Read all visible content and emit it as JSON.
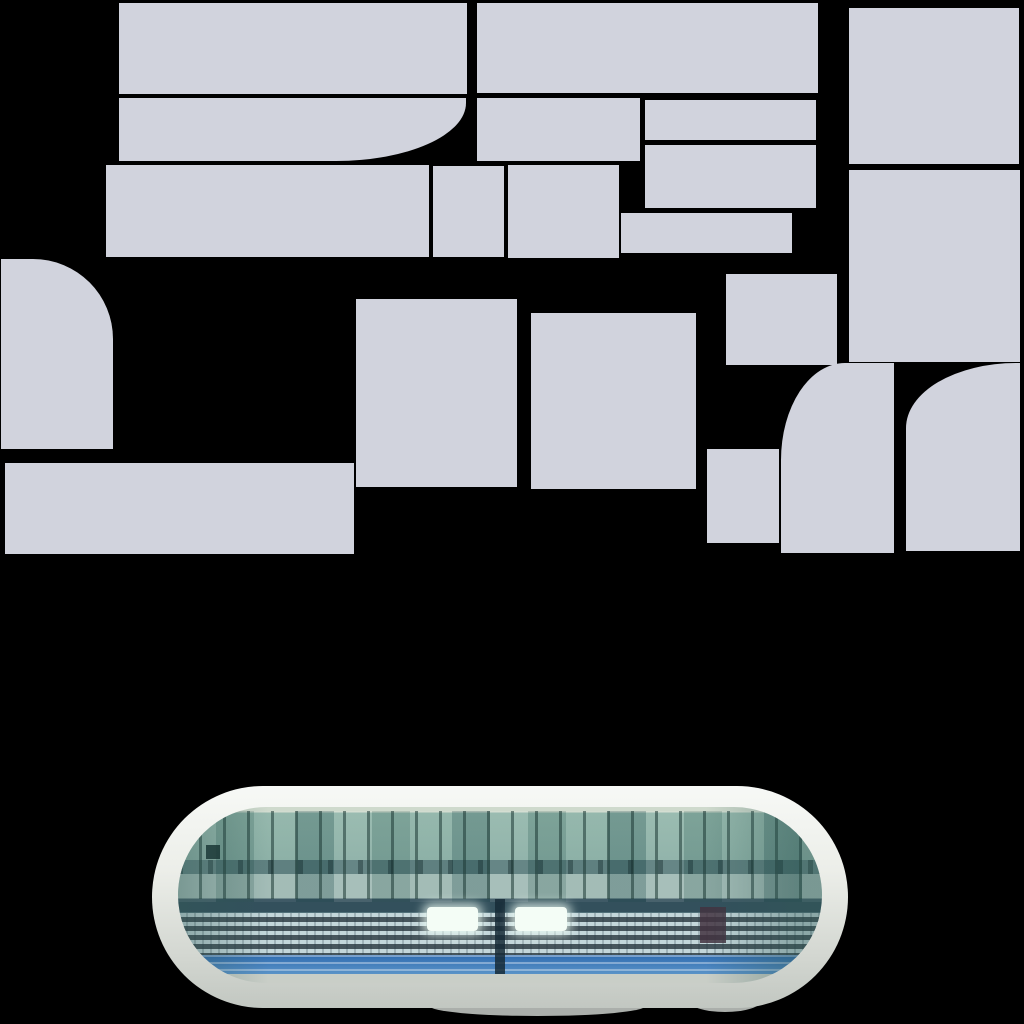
{
  "canvas": {
    "width": 1024,
    "height": 1024
  },
  "colors": {
    "background": "#000000",
    "tile": "#d1d3dd",
    "rim_top": "#f7f9f6",
    "rim_mid": "#eceee9",
    "rim_low": "#d2d6d0",
    "rim_bottom": "#c2c7c1",
    "photo_top": "#cfdacd",
    "glass_light": "#8fb4a8",
    "glass_deep": "#86aca2",
    "transom": "#557878",
    "mid_band": "#9db8b2",
    "stand_dark": "#33505c",
    "rows_base": "#6e8f96",
    "seat_light": "#c3d6da",
    "seat_dark": "#46555c",
    "blue_dark": "#2f6cb0",
    "blue_light": "#5b93c8",
    "base_band": "#c9cec7",
    "glare": "#f4fdf6",
    "maroon": "#43333f",
    "side_shade": "rgba(47,90,84,0.38)",
    "foot_shadow": "#abafab"
  },
  "atlas": {
    "description": "blank light-gray texture tiles on black background",
    "tiles": [
      {
        "id": "row1-left",
        "x": 119,
        "y": 3,
        "w": 348,
        "h": 91
      },
      {
        "id": "row1-mid",
        "x": 477,
        "y": 3,
        "w": 341,
        "h": 90
      },
      {
        "id": "right-col-top",
        "x": 849,
        "y": 8,
        "w": 170,
        "h": 156
      },
      {
        "id": "row2-curved",
        "x": 119,
        "y": 98,
        "w": 347,
        "h": 63,
        "radius": "0 0 130px 0 / 0 0 58px 0"
      },
      {
        "id": "row2-mid",
        "x": 477,
        "y": 98,
        "w": 163,
        "h": 63
      },
      {
        "id": "row2-right",
        "x": 645,
        "y": 100,
        "w": 171,
        "h": 40
      },
      {
        "id": "row3-left",
        "x": 106,
        "y": 165,
        "w": 323,
        "h": 92
      },
      {
        "id": "row3-small",
        "x": 433,
        "y": 166,
        "w": 71,
        "h": 91
      },
      {
        "id": "row3-mid",
        "x": 508,
        "y": 165,
        "w": 111,
        "h": 93
      },
      {
        "id": "row3-right",
        "x": 645,
        "y": 145,
        "w": 171,
        "h": 63
      },
      {
        "id": "row3-lower-strip",
        "x": 621,
        "y": 213,
        "w": 171,
        "h": 40
      },
      {
        "id": "right-col-mid",
        "x": 849,
        "y": 170,
        "w": 171,
        "h": 192
      },
      {
        "id": "left-edge-round",
        "x": 1,
        "y": 259,
        "w": 112,
        "h": 190,
        "radius": "0 80px 0 0"
      },
      {
        "id": "mid-left-block",
        "x": 356,
        "y": 299,
        "w": 161,
        "h": 188
      },
      {
        "id": "mid-right-block",
        "x": 531,
        "y": 313,
        "w": 165,
        "h": 176
      },
      {
        "id": "small-upper-block",
        "x": 726,
        "y": 274,
        "w": 111,
        "h": 91
      },
      {
        "id": "bottom-left-bar",
        "x": 5,
        "y": 463,
        "w": 349,
        "h": 91
      },
      {
        "id": "small-lower-block",
        "x": 707,
        "y": 449,
        "w": 72,
        "h": 94
      },
      {
        "id": "round-corner-a",
        "x": 781,
        "y": 363,
        "w": 113,
        "h": 190,
        "radius": "64px 0 0 0 / 97px 0 0 0"
      },
      {
        "id": "round-corner-b",
        "x": 906,
        "y": 363,
        "w": 114,
        "h": 188,
        "radius": "110px 0 0 0 / 65px 0 0 0"
      }
    ]
  },
  "capsule": {
    "x": 152,
    "y": 786,
    "w": 696,
    "h": 222,
    "radius": 111,
    "subject": "glass grandstand facade with seat rows, floodlight glare and blue fascia stripes"
  }
}
